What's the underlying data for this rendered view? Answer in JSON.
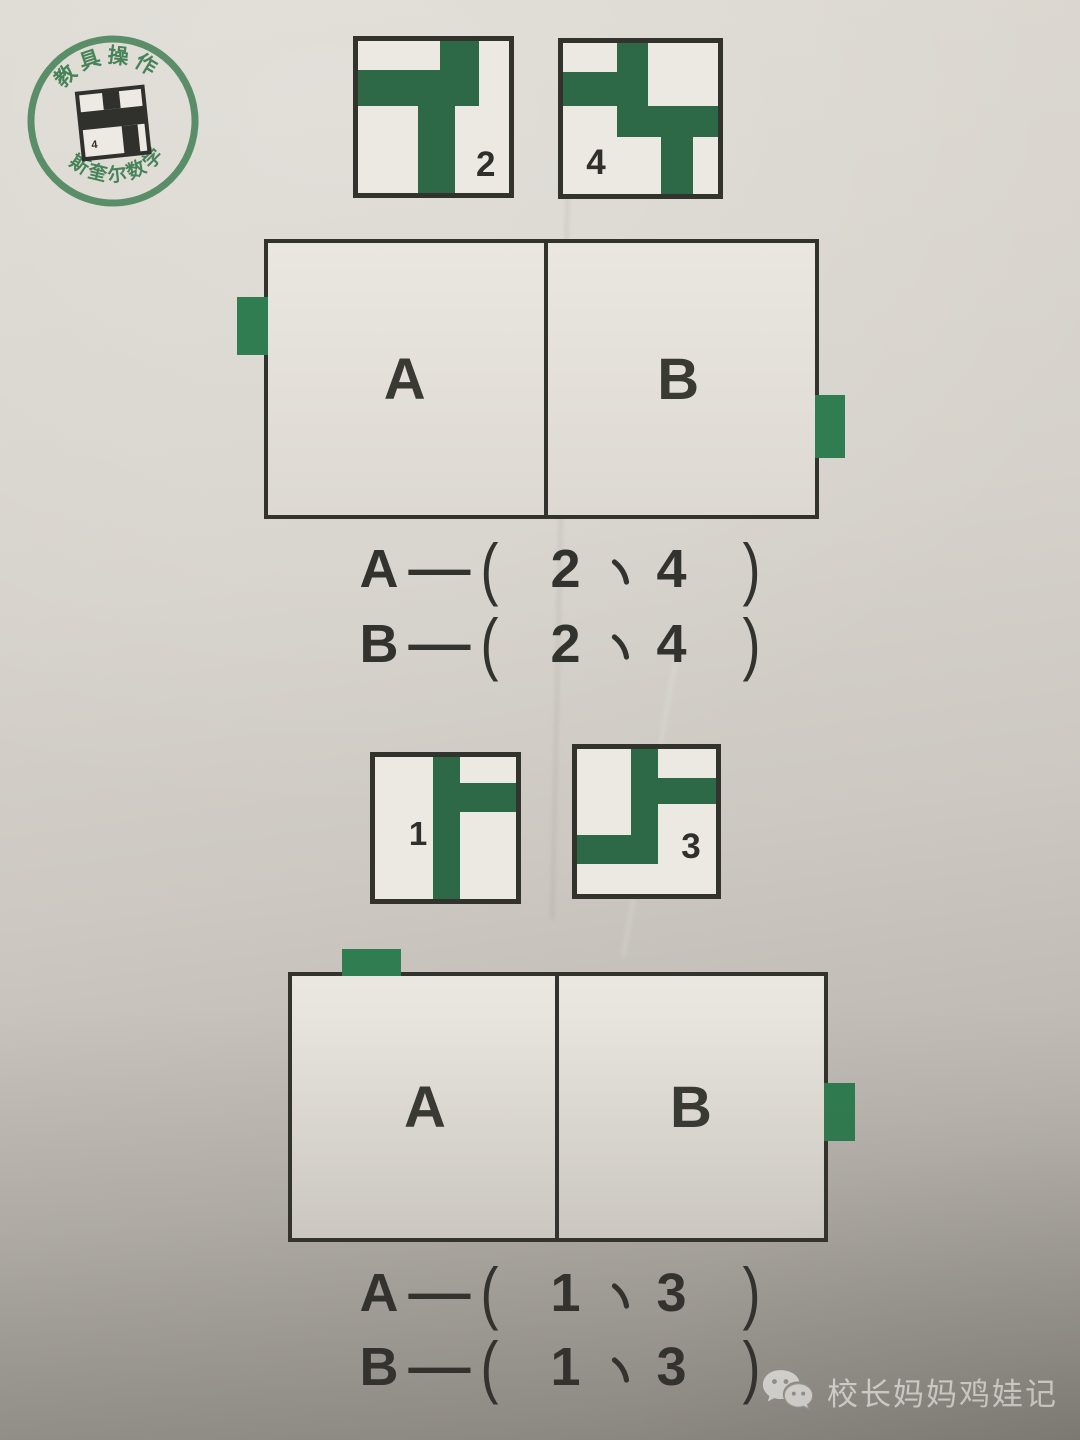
{
  "colors": {
    "green": "#2d6847",
    "tab_green": "#2f7d50",
    "ink": "#32322e",
    "stamp_green": "#3b7c4f"
  },
  "stamp": {
    "top_text": "教具操作",
    "bottom_text": "斯奎尔数学",
    "logo_number": "4"
  },
  "cards": [
    {
      "number": "2",
      "rects": [
        {
          "l": 54,
          "t": 0,
          "w": 26,
          "h": 43
        },
        {
          "l": 0,
          "t": 19,
          "w": 54,
          "h": 24
        },
        {
          "l": 40,
          "t": 43,
          "w": 24,
          "h": 57
        }
      ]
    },
    {
      "number": "4",
      "rects": [
        {
          "l": 35,
          "t": 0,
          "w": 20,
          "h": 62
        },
        {
          "l": 0,
          "t": 19,
          "w": 35,
          "h": 23
        },
        {
          "l": 55,
          "t": 42,
          "w": 45,
          "h": 20
        },
        {
          "l": 63,
          "t": 62,
          "w": 21,
          "h": 38
        }
      ]
    },
    {
      "number": "1",
      "rects": [
        {
          "l": 41,
          "t": 0,
          "w": 19,
          "h": 100
        },
        {
          "l": 60,
          "t": 18,
          "w": 40,
          "h": 21
        }
      ]
    },
    {
      "number": "3",
      "rects": [
        {
          "l": 39,
          "t": 0,
          "w": 19,
          "h": 79
        },
        {
          "l": 58,
          "t": 20,
          "w": 42,
          "h": 18
        },
        {
          "l": 0,
          "t": 59,
          "w": 39,
          "h": 20
        }
      ]
    }
  ],
  "dominoes": [
    {
      "left_label": "A",
      "right_label": "B",
      "tabs": [
        "left",
        "right"
      ]
    },
    {
      "left_label": "A",
      "right_label": "B",
      "tabs": [
        "top",
        "right"
      ]
    }
  ],
  "punct": {
    "dash": "—",
    "open": "(",
    "close": ")",
    "comma": "、"
  },
  "answers": [
    {
      "label": "A",
      "n1": "2",
      "n2": "4",
      "text": "A—（ 2 、 4 ）"
    },
    {
      "label": "B",
      "n1": "2",
      "n2": "4",
      "text": "B—（ 2 、 4 ）"
    },
    {
      "label": "A",
      "n1": "1",
      "n2": "3",
      "text": "A—（ 1 、 3 ）"
    },
    {
      "label": "B",
      "n1": "1",
      "n2": "3",
      "text": "B—（ 1 、 3 ）"
    }
  ],
  "watermark": {
    "text": "校长妈妈鸡娃记"
  }
}
